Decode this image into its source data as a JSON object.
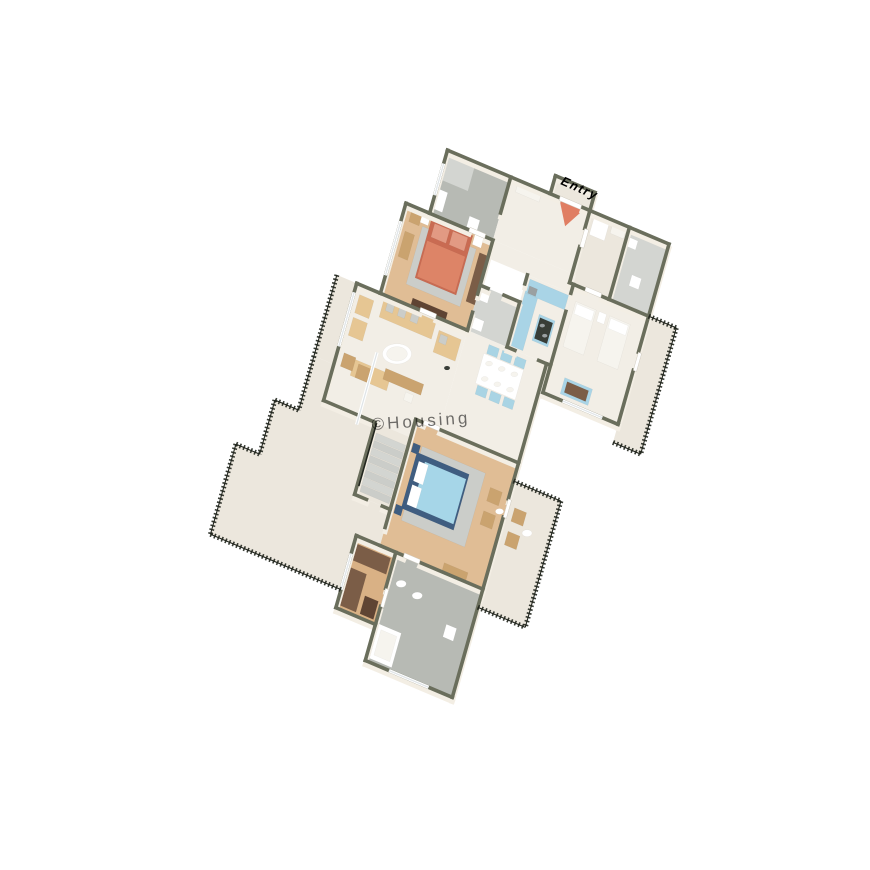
{
  "scene": {
    "title": "3D isometric floor plan render",
    "description": "Top-down 3D render of a 3-bedroom apartment with terrace and balconies",
    "canvas": {
      "width": 870,
      "height": 870,
      "background": "#ffffff"
    }
  },
  "labels": {
    "entry": "Entry",
    "watermark": "©Housing"
  },
  "colors": {
    "wall_top": "#6a6e5c",
    "wall_face": "#f3eee4",
    "floor_marble": "#f2eee6",
    "floor_marble2": "#ece7dd",
    "floor_wood": "#e0bd95",
    "floor_wood2": "#d9b185",
    "floor_tile": "#b7bab4",
    "floor_tile_light": "#d3d5d1",
    "white": "#ffffff",
    "off_white": "#f6f4ee",
    "rug": "#cbcdc9",
    "bed_coral": "#dd8467",
    "bed_coral_dark": "#c96b52",
    "pillow_coral": "#e29a83",
    "bed_blue": "#a6d6e8",
    "bed_blue_dark": "#3f5d80",
    "sofa_tan": "#e6c693",
    "chair_blue": "#a9d4e4",
    "kitchen_blue": "#a9d4e6",
    "counter_dark": "#383d37",
    "wardrobe_brown": "#7b5d47",
    "wardrobe_dark": "#5f4433",
    "wood_furn": "#caa36f",
    "railing_dark": "#22261e",
    "glass": "#dfe4e7",
    "steel": "#9aa0a2",
    "entry_red": "#d94f2b",
    "watermark_gray": "#c8c3ba"
  },
  "rooms": [
    {
      "name": "Master Bathroom",
      "floor": "grey tile",
      "features": [
        "shower",
        "toilet",
        "vanity"
      ]
    },
    {
      "name": "Foyer / Entry",
      "floor": "marble",
      "features": [
        "entry arrow",
        "shoe rack"
      ]
    },
    {
      "name": "Utility Room",
      "floor": "marble",
      "features": [
        "washing machine"
      ]
    },
    {
      "name": "Toilet",
      "floor": "tile",
      "features": [
        "toilet",
        "basin"
      ]
    },
    {
      "name": "Master Bedroom",
      "floor": "wood",
      "features": [
        "coral double bed",
        "wardrobe",
        "bench",
        "TV unit"
      ]
    },
    {
      "name": "Kitchen",
      "floor": "marble",
      "features": [
        "blue cabinets",
        "island with hob"
      ]
    },
    {
      "name": "Common Bathroom",
      "floor": "light tile",
      "features": [
        "toilet",
        "basin"
      ]
    },
    {
      "name": "Bedroom 2",
      "floor": "marble",
      "features": [
        "twin beds",
        "blue dresser"
      ]
    },
    {
      "name": "Right Balcony",
      "floor": "marble",
      "features": [
        "black railing"
      ]
    },
    {
      "name": "Living Room",
      "floor": "marble",
      "features": [
        "tan sofa set",
        "round coffee table",
        "chaise"
      ]
    },
    {
      "name": "Dining Area",
      "floor": "marble",
      "features": [
        "white table",
        "6 blue chairs",
        "plates"
      ]
    },
    {
      "name": "Staircase",
      "floor": "concrete steps",
      "features": [
        "handrail"
      ]
    },
    {
      "name": "Bedroom 3",
      "floor": "wood",
      "features": [
        "blue double bed",
        "rug",
        "armchairs"
      ]
    },
    {
      "name": "Rear Balcony",
      "floor": "marble",
      "features": [
        "wicker chairs",
        "round table",
        "black railing"
      ]
    },
    {
      "name": "Dressing Area",
      "floor": "wood",
      "features": [
        "brown wardrobes"
      ]
    },
    {
      "name": "Bathroom 3",
      "floor": "grey tile",
      "features": [
        "bathtub",
        "two basins",
        "toilet"
      ]
    },
    {
      "name": "Terrace",
      "floor": "marble",
      "features": [
        "stepped edge",
        "decorative black railing"
      ]
    }
  ]
}
